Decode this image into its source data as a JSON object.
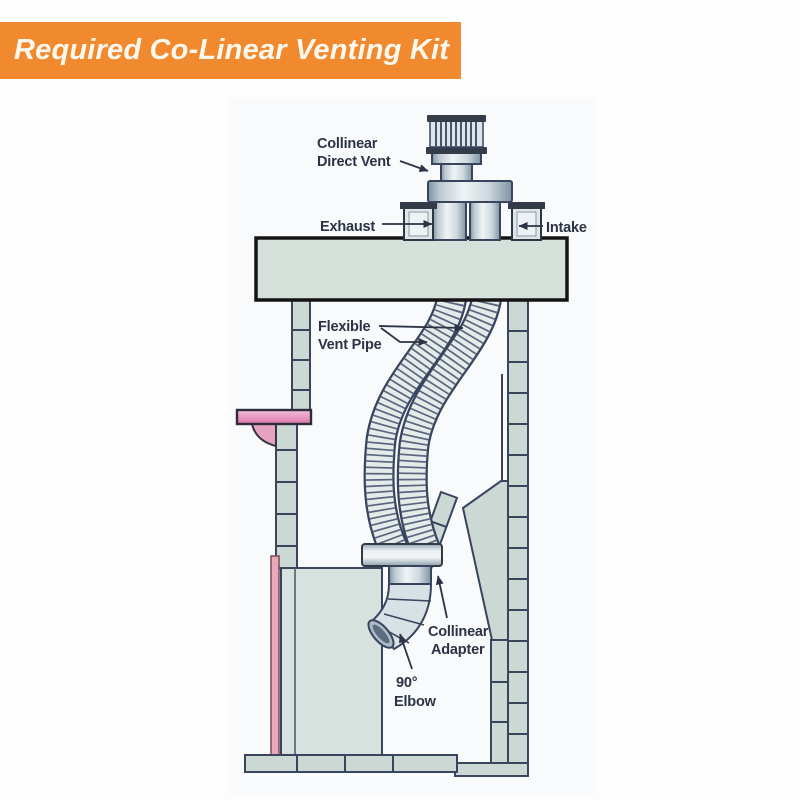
{
  "banner": {
    "title": "Required Co-Linear Venting Kit"
  },
  "diagram": {
    "labels": {
      "direct_vent_1": "Collinear",
      "direct_vent_2": "Direct Vent",
      "exhaust": "Exhaust",
      "intake": "Intake",
      "flex_1": "Flexible",
      "flex_2": "Vent Pipe",
      "adapter_1": "Collinear",
      "adapter_2": "Adapter",
      "elbow_1": "90°",
      "elbow_2": "Elbow"
    },
    "colors": {
      "banner_orange": "#F1892E",
      "banner_text": "#FDF8EE",
      "label_text": "#2B3344",
      "outline_navy": "#39445F",
      "masonry_fill": "#CCD8D4",
      "crown_fill": "#D6E0DB",
      "mantel_pink": "#E99FC2",
      "facing_pink": "#E8A9BA",
      "metal_light": "#E4EBE8",
      "rib_color": "#5B6580"
    }
  }
}
